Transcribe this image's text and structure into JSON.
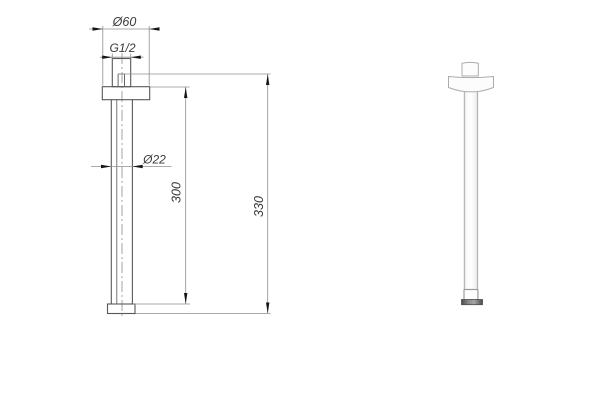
{
  "drawing": {
    "dimensions": {
      "flange_diameter": "Ø60",
      "thread_size": "G1/2",
      "pipe_diameter": "Ø22",
      "arm_length": "300",
      "overall_length": "330"
    },
    "colors": {
      "object_line": "#585858",
      "dimension_line": "#8f8f8f",
      "arrow": "#151515",
      "text": "#3a3a3a",
      "render_outline": "#acacac",
      "render_cap": "#555555",
      "background": "#ffffff"
    }
  }
}
